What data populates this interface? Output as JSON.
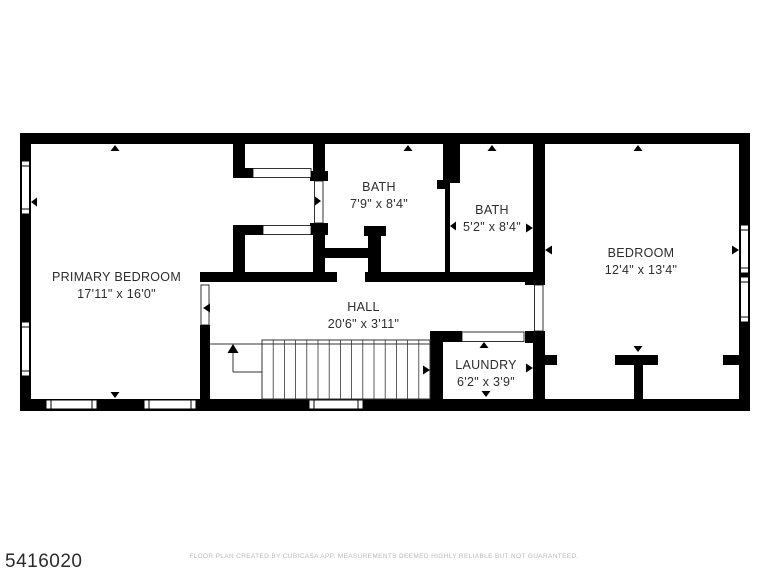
{
  "plan": {
    "rooms": [
      {
        "id": "primary-bedroom",
        "name": "PRIMARY BEDROOM",
        "dims": "17'11\" x 16'0\""
      },
      {
        "id": "bath-1",
        "name": "BATH",
        "dims": "7'9\" x 8'4\""
      },
      {
        "id": "bath-2",
        "name": "BATH",
        "dims": "5'2\" x 8'4\""
      },
      {
        "id": "bedroom",
        "name": "BEDROOM",
        "dims": "12'4\" x 13'4\""
      },
      {
        "id": "hall",
        "name": "HALL",
        "dims": "20'6\" x 3'11\""
      },
      {
        "id": "laundry",
        "name": "LAUNDRY",
        "dims": "6'2\" x 3'9\""
      }
    ],
    "features": {
      "stairs_direction": "up"
    }
  },
  "footer": {
    "disclaimer": "FLOOR PLAN CREATED BY CUBICASA APP. MEASUREMENTS DEEMED HIGHLY RELIABLE BUT NOT GUARANTEED."
  },
  "watermark": {
    "listing_id": "5416020"
  },
  "colors": {
    "walls": "#000000",
    "room_text": "#2d2d2d",
    "disclaimer_text": "#b9b9b9",
    "listing_id_text": "#2b2b2b",
    "background": "#ffffff"
  }
}
